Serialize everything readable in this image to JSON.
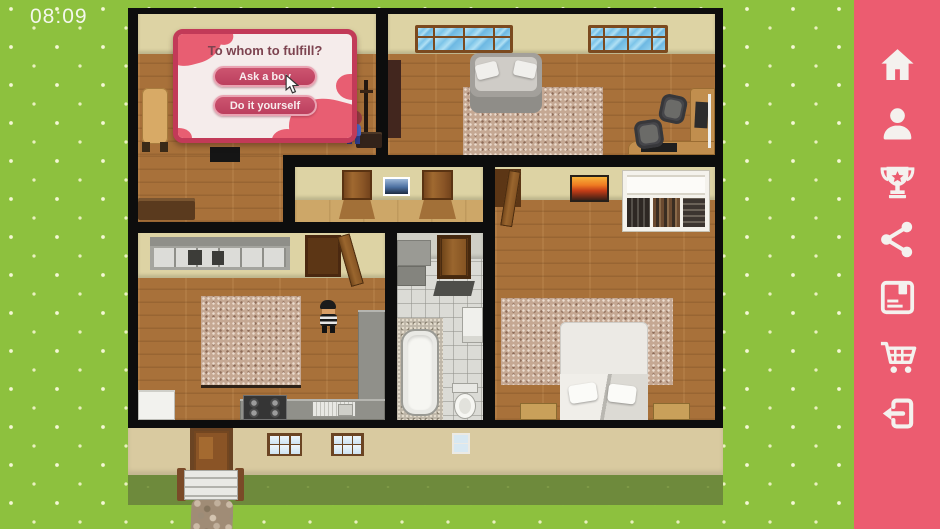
{
  "hud": {
    "timer": "08:09"
  },
  "dialog": {
    "title": "To whom to fulfill?",
    "buttons": [
      {
        "label": "Ask a boy"
      },
      {
        "label": "Do it yourself"
      }
    ],
    "frame_color": "#c23a58",
    "button_color": "#c74866",
    "blob_color": "#e85e72"
  },
  "sidebar": {
    "background": "#ec5c70",
    "icon_color": "#f4f1ee",
    "items": [
      {
        "name": "home"
      },
      {
        "name": "profile"
      },
      {
        "name": "achievements"
      },
      {
        "name": "share"
      },
      {
        "name": "save"
      },
      {
        "name": "shop"
      },
      {
        "name": "exit"
      }
    ]
  },
  "scene": {
    "grass_color": "#8dc13e",
    "grass_shadow_color": "#6e8a3c",
    "wall_color": "#0d0d0d",
    "rooms": [
      "study-room",
      "living-room",
      "hallway",
      "kitchen",
      "bathroom",
      "bedroom"
    ],
    "characters": [
      {
        "id": "girl-red-hair",
        "location": "study-room"
      },
      {
        "id": "boy-striped-shirt",
        "location": "kitchen"
      }
    ]
  }
}
